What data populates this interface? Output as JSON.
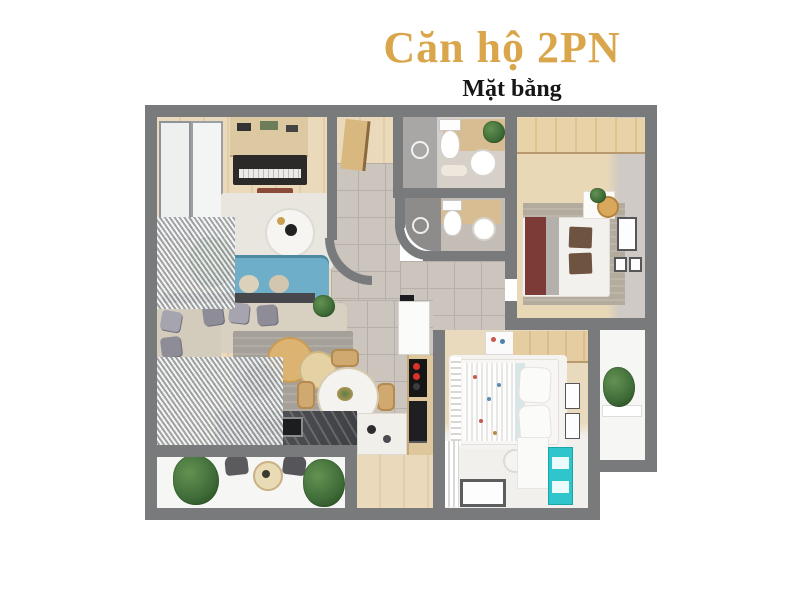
{
  "title": {
    "text": "Căn hộ 2PN"
  },
  "subtitle": {
    "text": "Mặt bằng"
  },
  "floor_plan": {
    "kind": "2-bedroom-apartment-top-view-render"
  },
  "colors": {
    "title_gold": "#D9A64B",
    "subtitle_black": "#161616",
    "wall_gray": "#797A7C",
    "tile_gray": "#CBC5BE",
    "wood_light": "#E8D9BB",
    "sofa_blue": "#6FAEC8",
    "cabinet_teal": "#2FC5CC",
    "bed_runner_maroon": "#7C3B37",
    "plant_green": "#3E6B37",
    "balcony_white": "#F6F6F5"
  }
}
